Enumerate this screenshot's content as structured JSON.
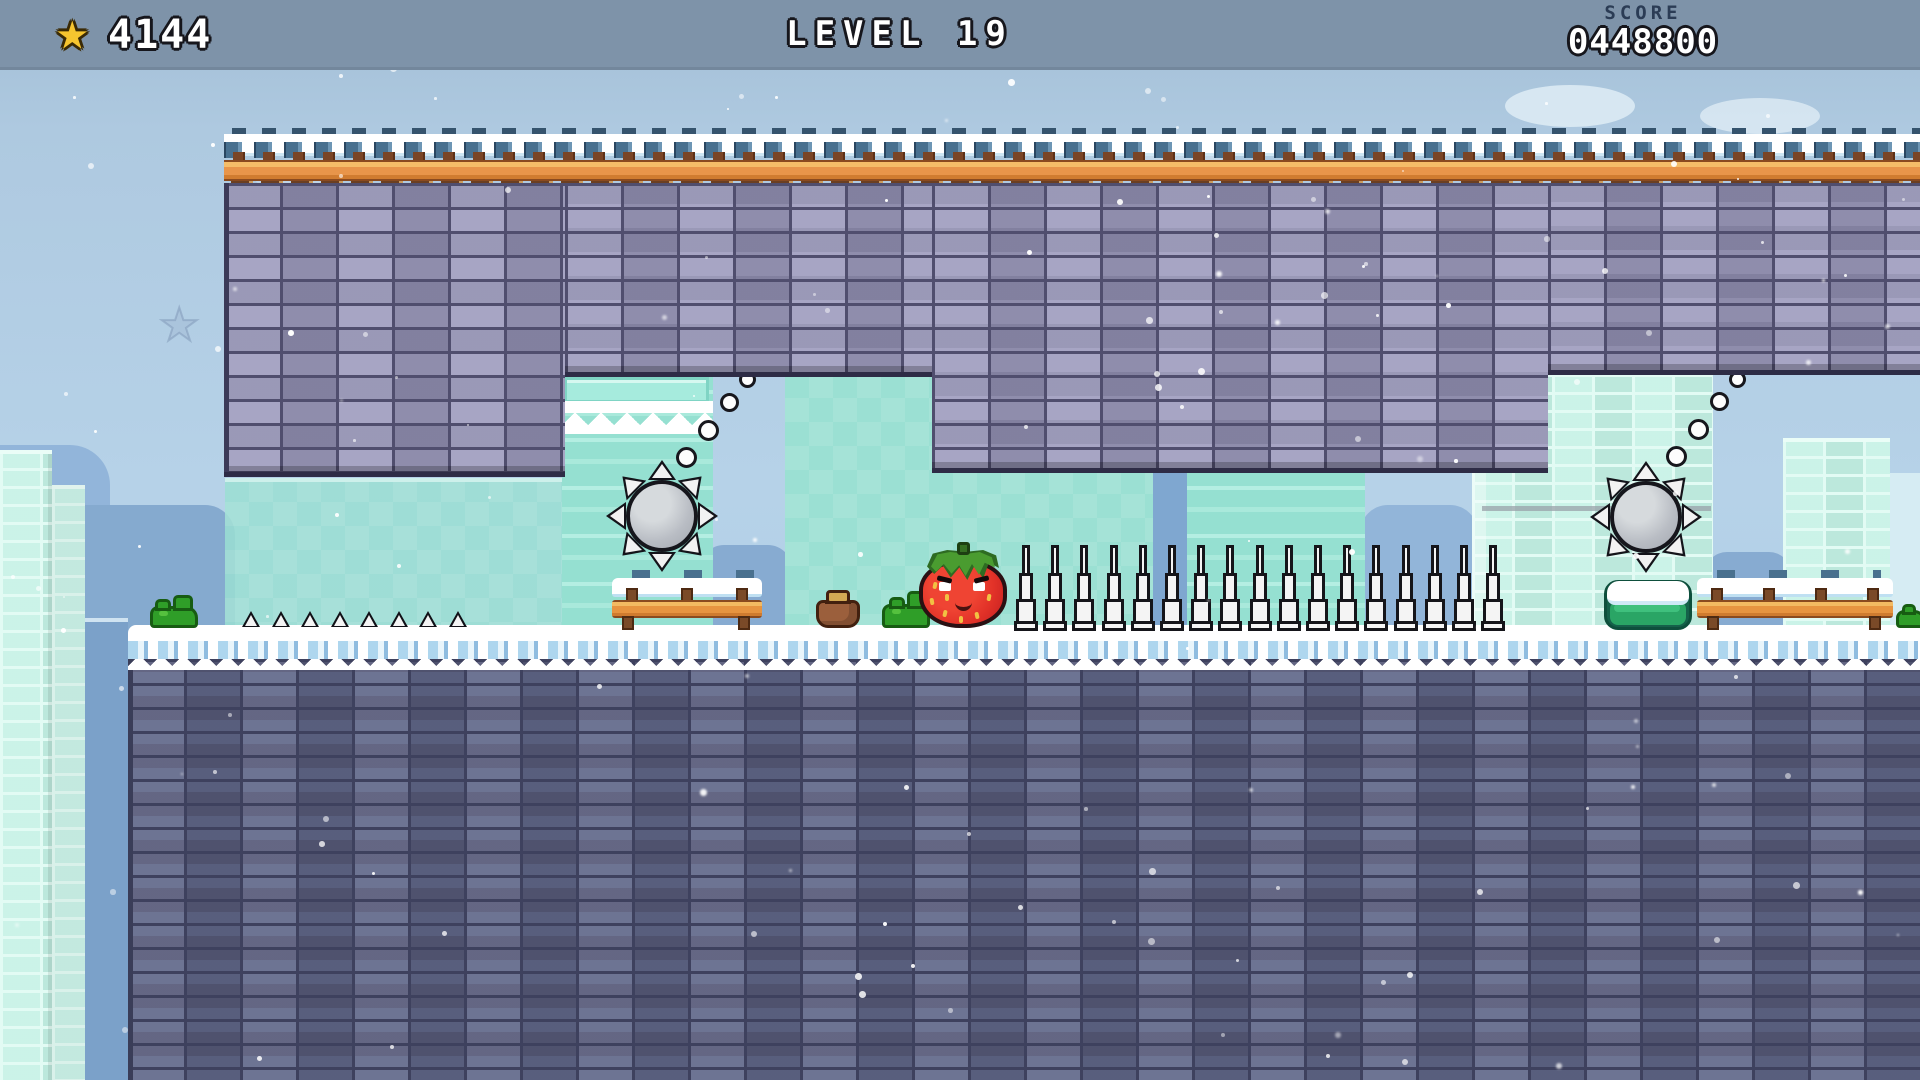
{
  "hud": {
    "star_icon": "star-icon",
    "stars": "4144",
    "level": "LEVEL 19",
    "score_label": "SCORE",
    "score_value": "0448800"
  },
  "game": {
    "theme": "winter snow platformer",
    "player": {
      "name": "strawberry",
      "expression": "determined-smile"
    },
    "hazards": {
      "saw_blades": 2,
      "saw_teeth_per_blade": 8,
      "tall_spikes": 17,
      "small_spikes": 8
    },
    "props": {
      "bushes": 3,
      "snow_mound": 1,
      "money_sack": 1,
      "wooden_fences": 2,
      "fence_posts": [
        3,
        4
      ],
      "bubble_trails": 2,
      "bubbles_per_trail": 4,
      "ghost_star": 1
    },
    "effects": {
      "snowfall": true,
      "snowflakes": 150
    }
  },
  "colors": {
    "hud_bar": "#7e93a9",
    "hud_text": "#ffffff",
    "score_label": "#2b3c55",
    "star_gold": "#f6c52f",
    "sky_top": "#a2bed5",
    "sky_bottom": "#aecde6",
    "brick_ceiling": "#9896ba",
    "brick_ground": "#5d6081",
    "mortar_dark": "#3e415e",
    "ice_teal": "#9be0d3",
    "ice_mint": "#c4f1e5",
    "rail_orange": "#e8954a",
    "wood_brown": "#7a4a28",
    "saw_gray": "#b9bdc4",
    "spike_white": "#f4f4f4",
    "strawberry_red": "#e23228",
    "leaf_green": "#4a9c30",
    "bush_green": "#2f9e28",
    "mound_green": "#2aa565",
    "sack_brown": "#9b5f3c",
    "snow_white": "#ffffff",
    "hill_blue": "#87abd1"
  }
}
